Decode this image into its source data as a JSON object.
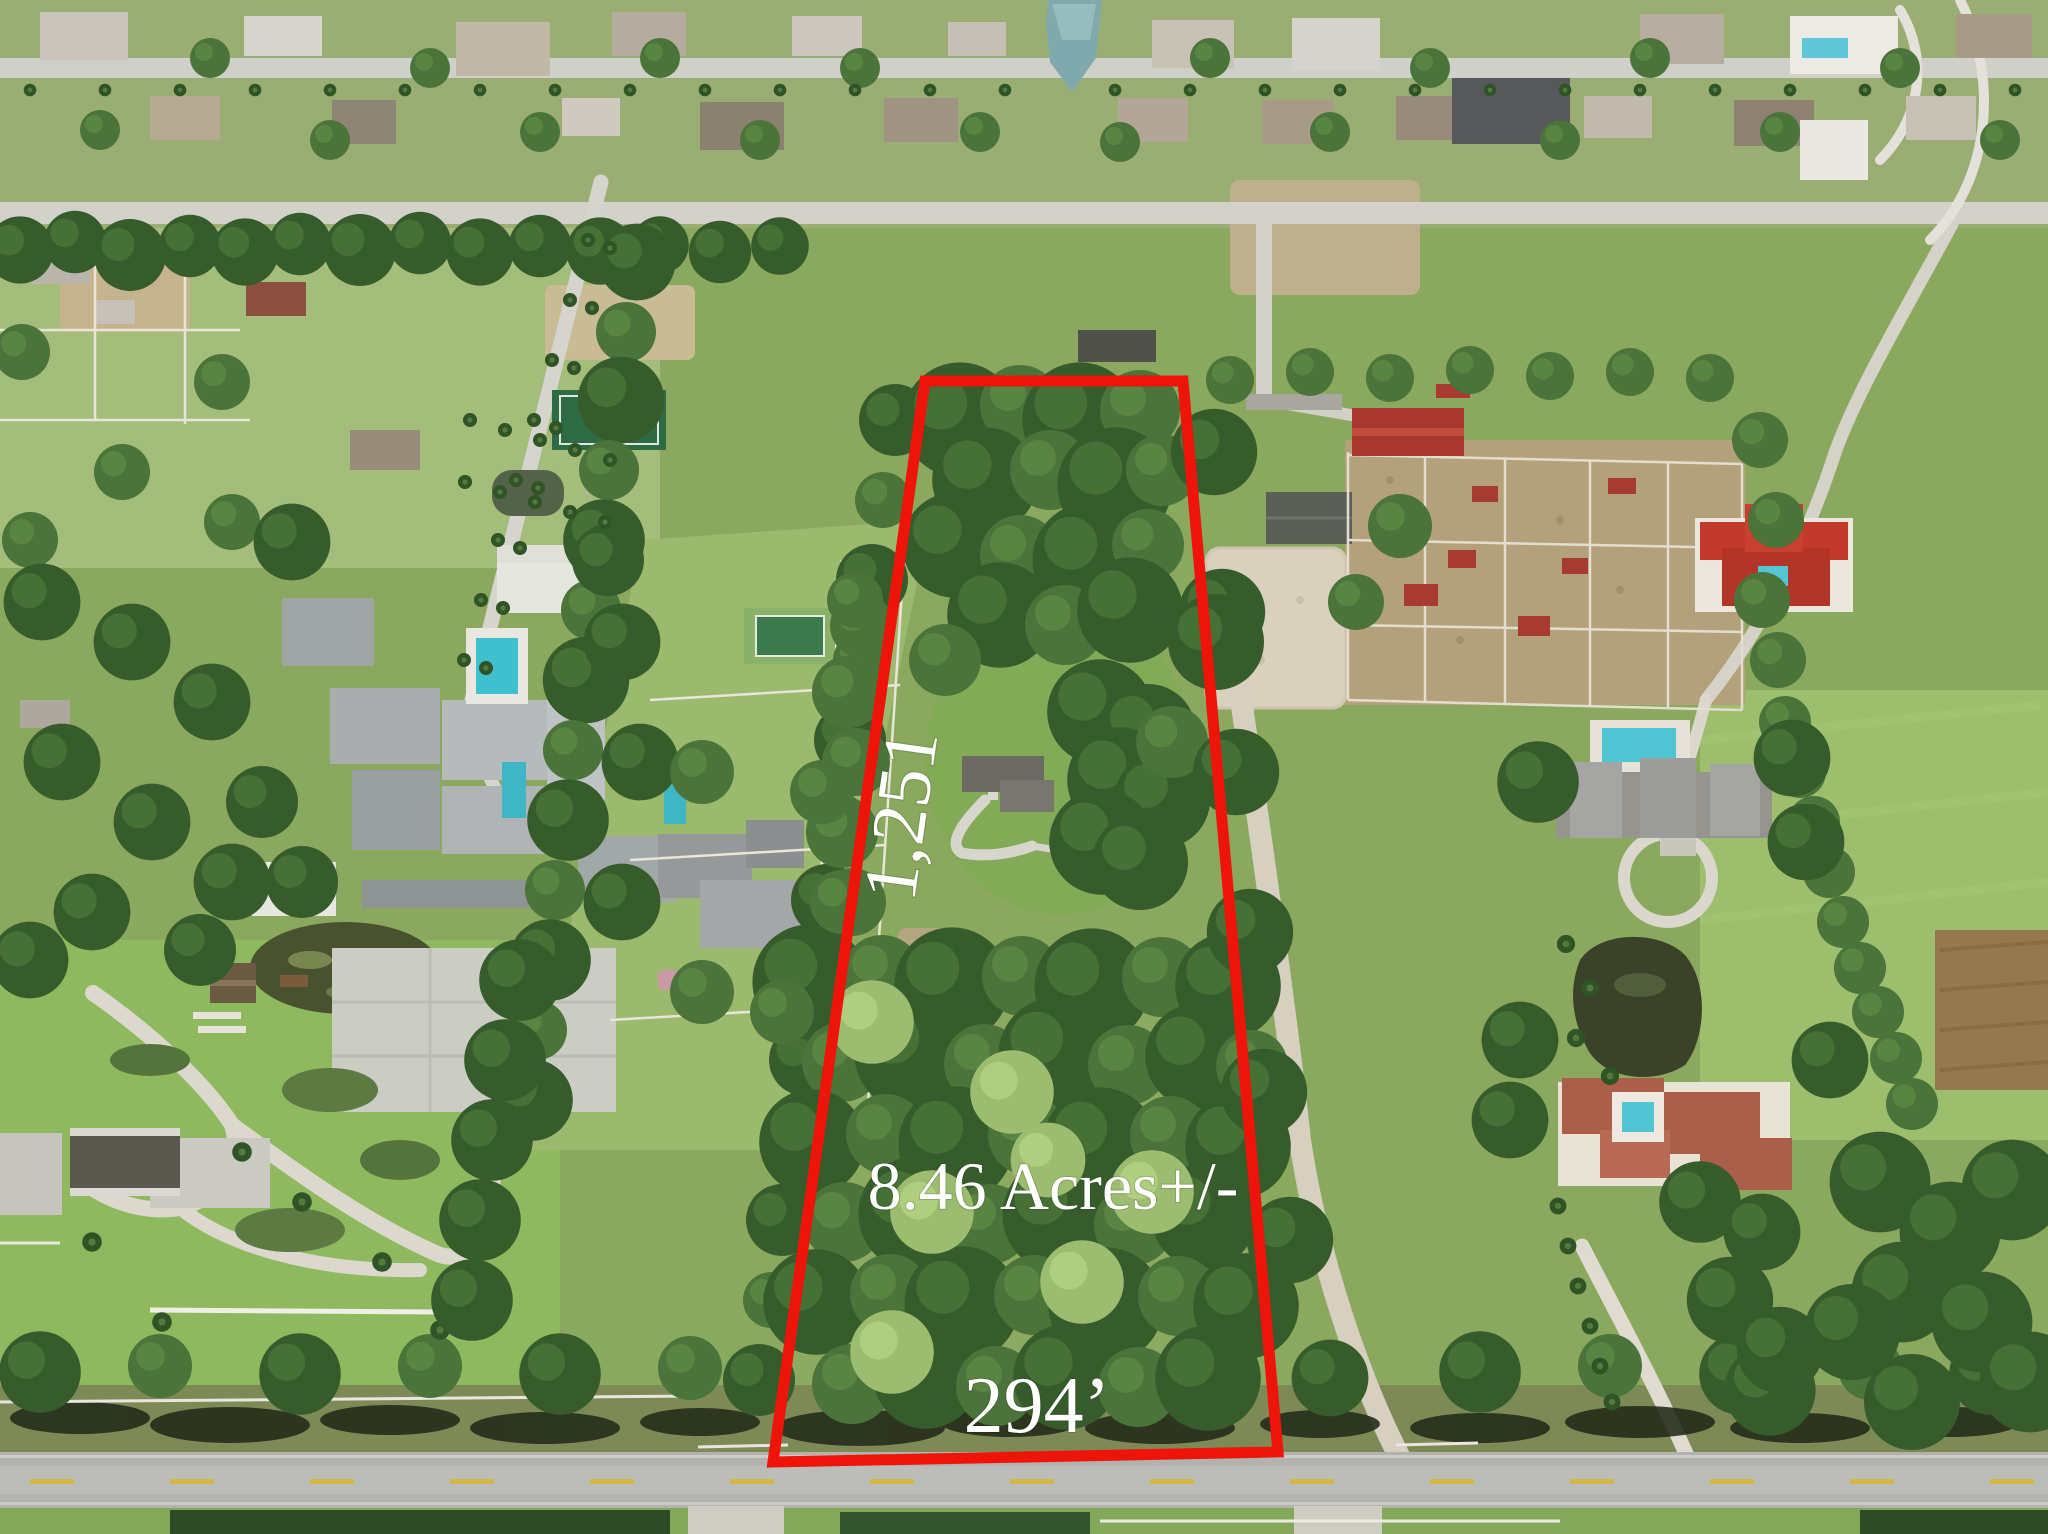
{
  "photo": {
    "type": "aerial-drone-photo",
    "scene": "Aerial view of a vacant wooded acreage parcel outlined in red, surrounded by luxury estates, equestrian farms, ponds and a frontage road",
    "outline_color": "#ee1409",
    "label_color": "#ffffff"
  },
  "annotations": {
    "side_length_label": "1,251",
    "acreage_label": "8.46 Acres+/-",
    "frontage_label": "294’"
  }
}
